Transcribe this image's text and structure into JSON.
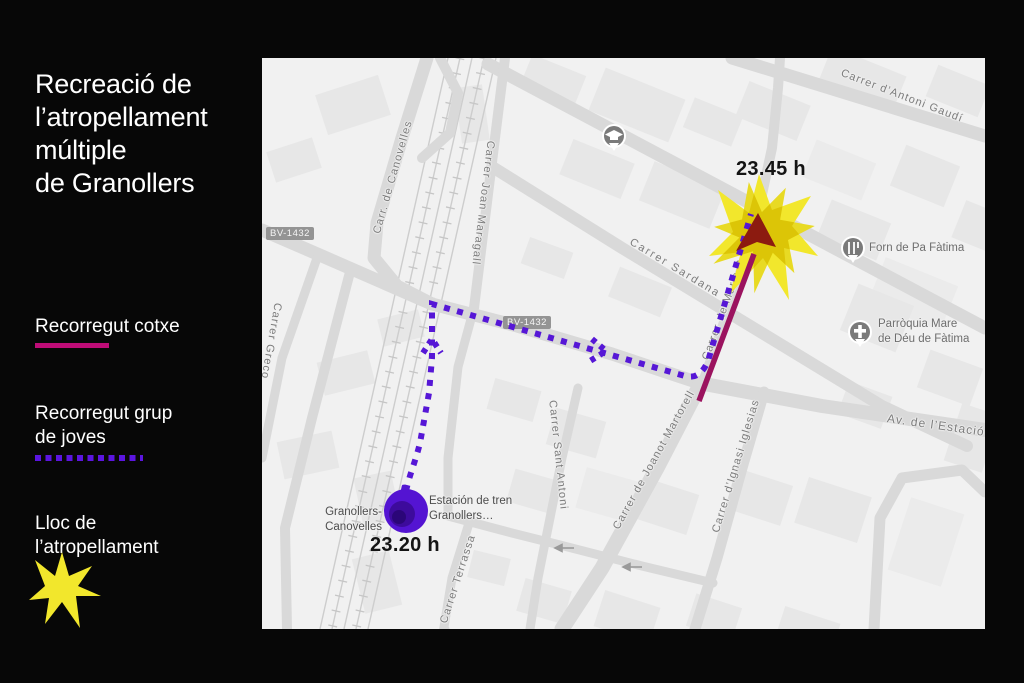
{
  "panel": {
    "title_lines": [
      "Recreació de",
      "l’atropellament",
      "múltiple",
      "de Granollers"
    ],
    "legend": {
      "car": {
        "label": "Recorregut cotxe"
      },
      "group": {
        "label_lines": [
          "Recorregut grup",
          "de joves"
        ]
      },
      "place": {
        "label_lines": [
          "Lloc de",
          "l’atropellament"
        ],
        "icon": "impact-star-icon"
      }
    }
  },
  "map": {
    "times": {
      "impact": "23.45 h",
      "departure": "23.20 h"
    },
    "station": {
      "left_label": "Granollers-Canovelles",
      "right_label_lines": [
        "Estación de tren",
        "Granollers…"
      ]
    },
    "pois": {
      "school": {
        "icon": "graduation-cap-icon"
      },
      "forn": {
        "name": "Forn de Pa Fàtima",
        "icon": "bakery-icon"
      },
      "parroquia": {
        "name_lines": [
          "Parròquia Mare",
          "de Déu de Fàtima"
        ],
        "icon": "church-cross-icon"
      }
    },
    "badges": [
      "BV-1432",
      "BV-1432"
    ],
    "streets": [
      {
        "text": "Carr. de Canovelles"
      },
      {
        "text": "Carrer Joan Maragall"
      },
      {
        "text": "Carrer d’Antoni Gaudí"
      },
      {
        "text": "Carrer Sardana"
      },
      {
        "text": "Av. de l’Estació"
      },
      {
        "text": "Carrer de Joanot Martorell"
      },
      {
        "text": "Carrer d’Ignasi Iglesias"
      },
      {
        "text": "Carrer Sant Antoni"
      },
      {
        "text": "Carrer de Maria Palau"
      },
      {
        "text": "Carrer Terrassa"
      },
      {
        "text": "Carrer Greco"
      }
    ],
    "colors": {
      "car_route": "#9B135F",
      "car_arrowhead": "#8C1B10",
      "group_route": "#5617D6",
      "impact_star": "#F2E72C",
      "origin_marker": "#5414D2",
      "legend_car_line": "#BE0C77"
    }
  }
}
